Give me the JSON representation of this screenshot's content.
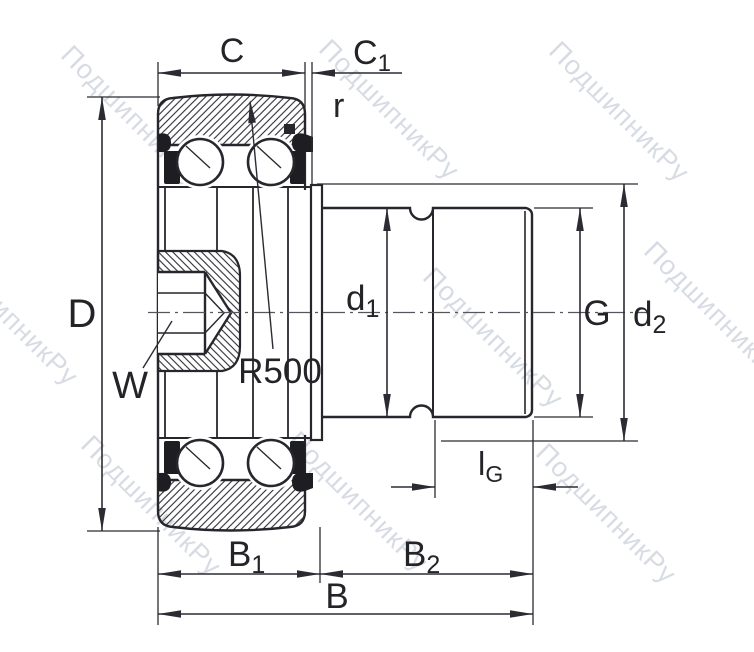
{
  "watermark": {
    "text": "ПодшипникРу"
  },
  "labels": {
    "C": "C",
    "C1": {
      "main": "C",
      "sub": "1"
    },
    "r": "r",
    "R500": "R500",
    "W": "W",
    "D": "D",
    "d1": {
      "main": "d",
      "sub": "1"
    },
    "G": "G",
    "d2": {
      "main": "d",
      "sub": "2"
    },
    "lG": {
      "main": "l",
      "sub": "G"
    },
    "B1": {
      "main": "B",
      "sub": "1"
    },
    "B2": {
      "main": "B",
      "sub": "2"
    },
    "B": "B"
  },
  "colors": {
    "line": "#26262c",
    "watermark": "#97a2b6",
    "background": "#ffffff"
  }
}
